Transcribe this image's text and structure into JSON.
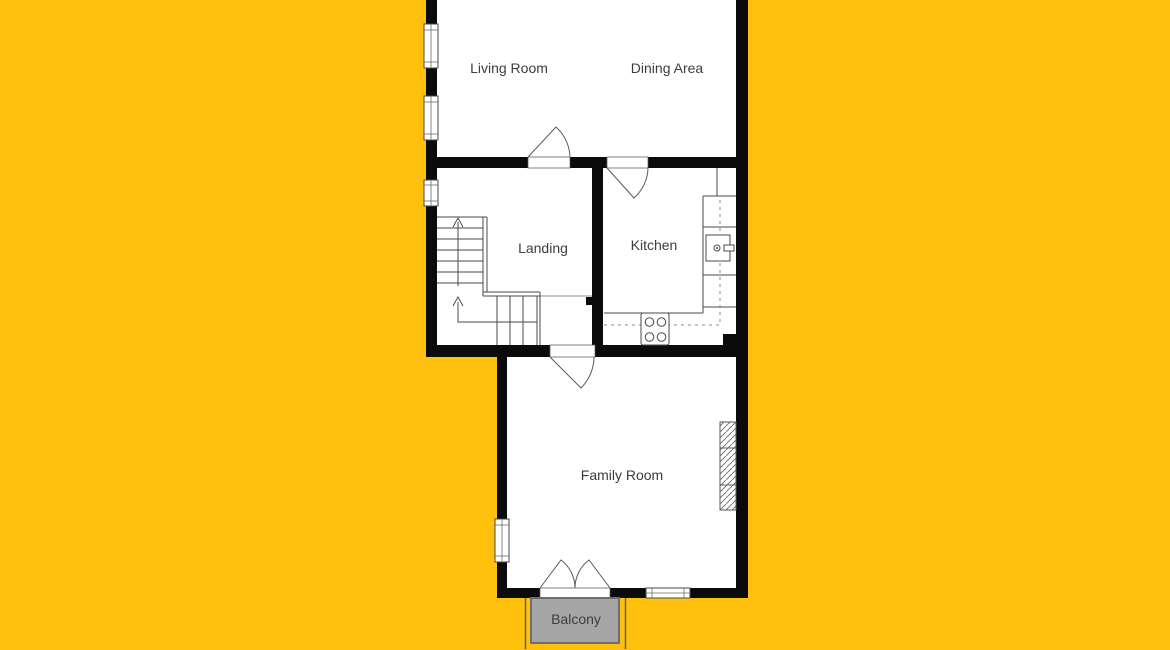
{
  "floor_plan": {
    "rooms": {
      "living_room": {
        "label": "Living Room"
      },
      "dining_area": {
        "label": "Dining Area"
      },
      "landing": {
        "label": "Landing"
      },
      "kitchen": {
        "label": "Kitchen"
      },
      "family_room": {
        "label": "Family Room"
      },
      "balcony": {
        "label": "Balcony"
      }
    },
    "symbols": [
      "window-symbol",
      "door-swing-symbol",
      "french-doors-symbol",
      "staircase-up-arrow",
      "kitchen-sink-symbol",
      "stove-4-burner-symbol",
      "radiator-hatch-symbol"
    ],
    "colors": {
      "background": "#FFC10D",
      "wall": "#0B0B0B",
      "floor": "#FFFFFF",
      "line": "#4A4A4A",
      "balcony_fill": "#A6A6A6",
      "balcony_border": "#6E6E6E",
      "label_text": "#3D3D3D"
    }
  }
}
